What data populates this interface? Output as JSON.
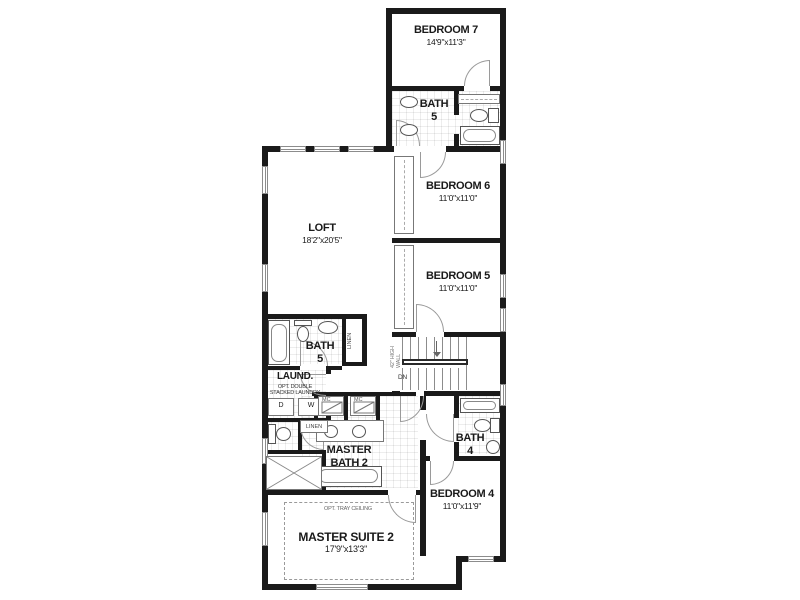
{
  "colors": {
    "wall": "#1a1a1a",
    "line": "#8c8c8c",
    "text": "#1a1a1a"
  },
  "rooms": [
    {
      "name": "BEDROOM 7",
      "dims": "14'9\"x11'3\""
    },
    {
      "name": "BATH",
      "name2": "5"
    },
    {
      "name": "BEDROOM 6",
      "dims": "11'0\"x11'0\""
    },
    {
      "name": "LOFT",
      "dims": "18'2\"x20'5\""
    },
    {
      "name": "BEDROOM 5",
      "dims": "11'0\"x11'0\""
    },
    {
      "name": "BATH",
      "name2": "5"
    },
    {
      "name": "LAUND."
    },
    {
      "name": "MASTER",
      "name2": "BATH 2"
    },
    {
      "name": "BATH",
      "name2": "4"
    },
    {
      "name": "BEDROOM 4",
      "dims": "11'0\"x11'9\""
    },
    {
      "name": "MASTER SUITE 2",
      "dims": "17'9\"x13'3\""
    }
  ],
  "stairs": {
    "down_label": "DN",
    "rail_label": "42\" HIGH WALL"
  },
  "closets": {
    "linen_tall": "LINEN",
    "linen_small": "LINEN",
    "cabinet_left": "MC",
    "cabinet_right": "MC"
  },
  "laundry": {
    "opt_line1": "OPT. DOUBLE",
    "opt_line2": "STACKED LAUNDRY",
    "dryer": "D",
    "washer": "W"
  },
  "options": {
    "tray_ceiling": "OPT. TRAY CEILING"
  }
}
